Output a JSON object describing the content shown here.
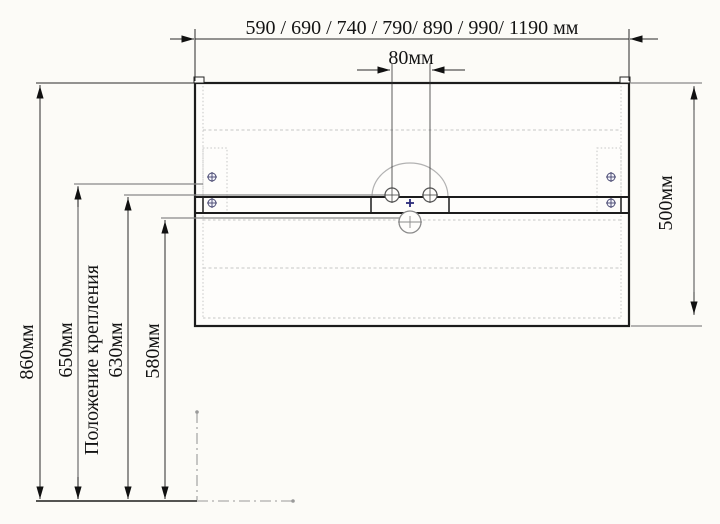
{
  "title": "Wall-hung vanity installation drawing",
  "labels": {
    "width_options": "590 / 690 / 740 / 790/ 890 / 990/ 1190 мм",
    "faucet_spacing": "80мм",
    "cabinet_height": "500мм",
    "floor_to_top": "860мм",
    "mounting_height": "650мм",
    "mounting_position": "Положение крепления",
    "faucet_height": "630мм",
    "drain_height": "580мм"
  },
  "dimensions_mm": {
    "width_options": [
      590,
      690,
      740,
      790,
      890,
      990,
      1190
    ],
    "faucet_hole_spacing": 80,
    "cabinet_height": 500,
    "floor_to_cabinet_top": 860,
    "mounting_bracket_height": 650,
    "faucet_outlet_height": 630,
    "drain_outlet_height": 580
  },
  "colors": {
    "background": "#fcfbf7",
    "line_main": "#1c1c1c",
    "line_gray": "#888888",
    "line_light_dash": "#c6c6c6",
    "screw_navy": "#45456e",
    "marker_blue": "#2b2b7a"
  }
}
